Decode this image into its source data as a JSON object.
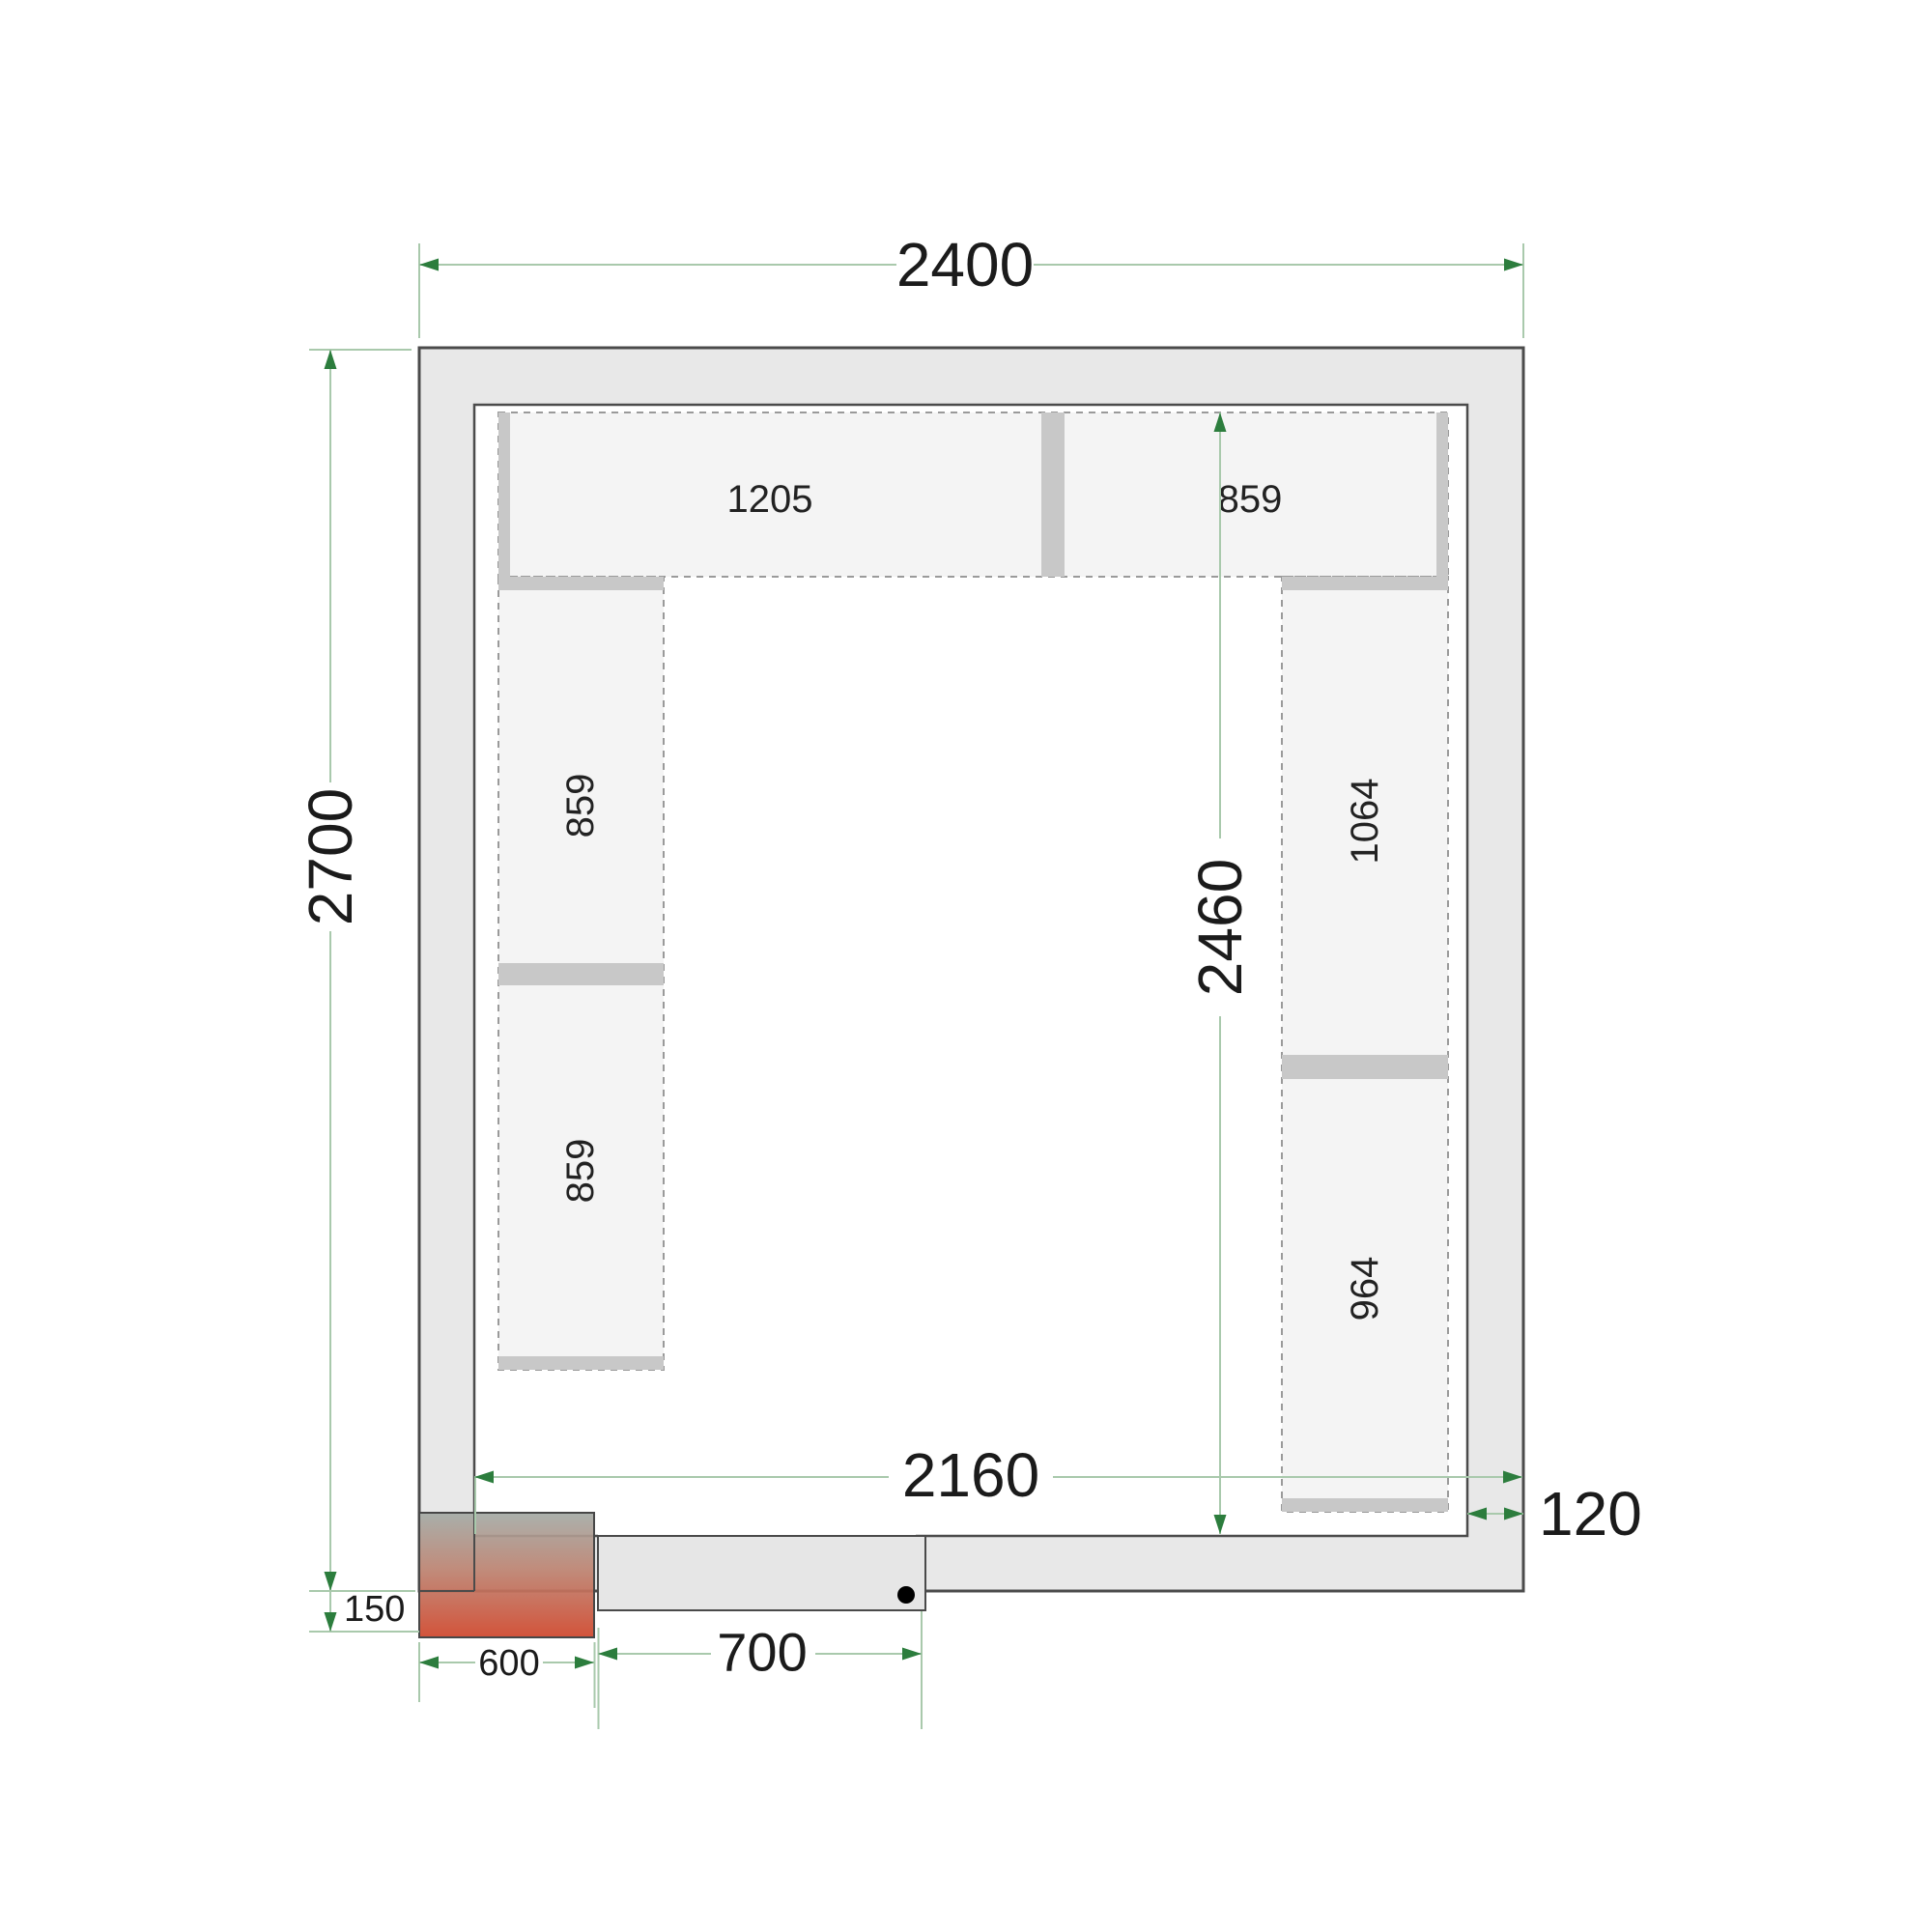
{
  "drawing": {
    "type": "cold-room floor plan (top view) with shelving layout",
    "dimensions": {
      "outer_width": "2400",
      "outer_depth": "2700",
      "inner_width": "2160",
      "inner_depth": "2460",
      "wall_thickness": "120",
      "cooling_unit_protrusion": "150",
      "cooling_unit_width": "600",
      "door_width": "700"
    },
    "shelves": {
      "top_left": "1205",
      "top_right": "859",
      "left_upper": "859",
      "left_lower": "859",
      "right_upper": "1064",
      "right_lower": "964"
    },
    "icons": {
      "door_handle": "black-dot"
    },
    "colors": {
      "wall_fill": "#e8e8e8",
      "wall_stroke": "#4b4b4b",
      "room_floor": "#ffffff",
      "shelf_fill": "#f4f4f4",
      "shelf_dash_stroke": "#9a9a9a",
      "support_bar": "#c8c8c8",
      "dimension_line": "#a9c9ac",
      "dimension_arrow": "#2c7d3d",
      "dimension_text": "#1b1b1b",
      "cooling_unit_top": "#a3aaa5",
      "cooling_unit_mid": "#bd8472",
      "cooling_unit_bottom": "#d04a30",
      "door_leaf_fill": "#e6e6e6"
    }
  }
}
